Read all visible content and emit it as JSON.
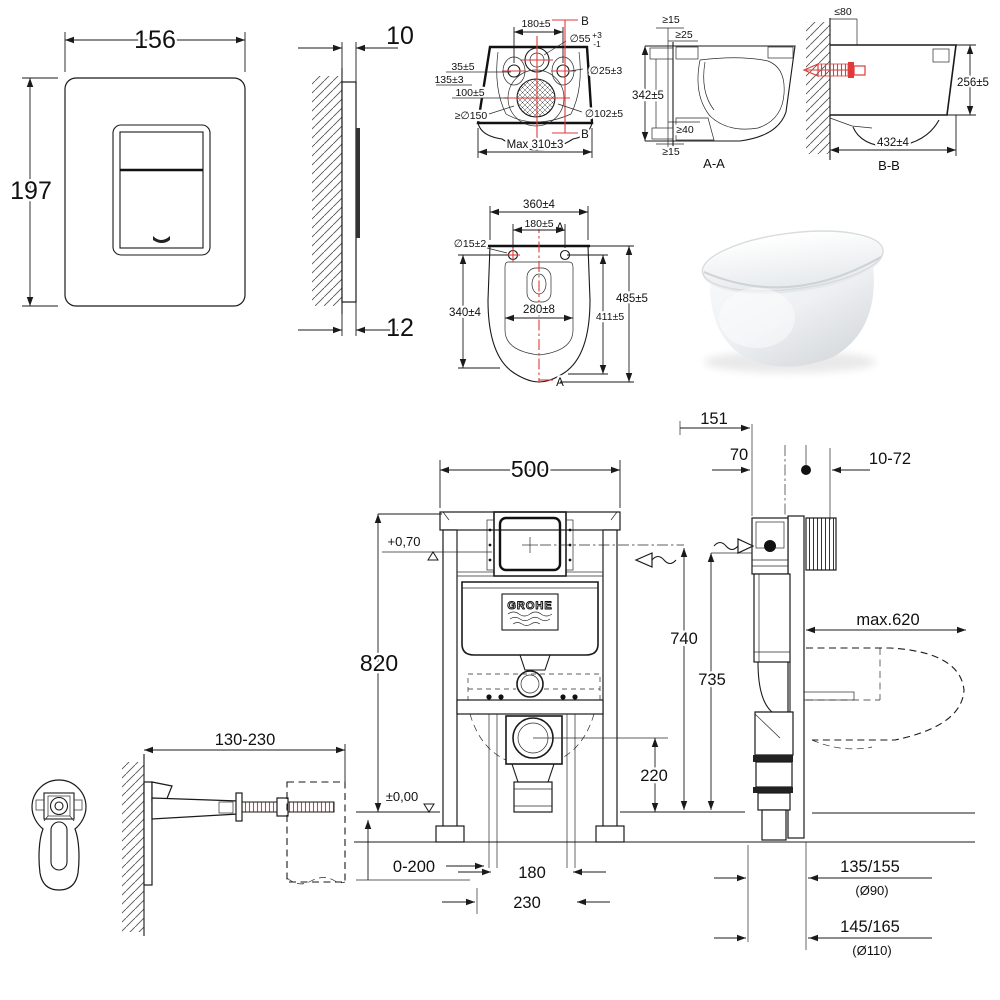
{
  "sheet": {
    "description": "GROHE wall-hung toilet and concealed cistern frame installation dimension drawing",
    "line_color": "#1a1a1a",
    "accent_red": "#e03a3a",
    "background": "#ffffff"
  },
  "views": {
    "pf": {
      "name": "flush-plate-front",
      "w": "156",
      "h": "197"
    },
    "ps": {
      "name": "flush-plate-side",
      "t": "10",
      "b": "12"
    },
    "rv": {
      "name": "toilet-rear-view",
      "spacing": "180±5",
      "inlet": "∅55",
      "tolu": "+3",
      "told": "-1",
      "a": "35±5",
      "b": "135±3",
      "c": "100±5",
      "fix": "∅25±3",
      "clr": "≥∅150",
      "out": "∅102±5",
      "maxw": "Max 310±3",
      "sec": "B"
    },
    "aa": {
      "name": "section-A-A",
      "t1": "≥15",
      "t2": "≥25",
      "h": "342±5",
      "b2": "≥40",
      "b1": "≥15",
      "lbl": "A-A"
    },
    "bb": {
      "name": "section-B-B",
      "t": "≤80",
      "h": "256±5",
      "w": "432±4",
      "lbl": "B-B"
    },
    "tv": {
      "name": "toilet-top-view",
      "w": "360±4",
      "sp": "180±5",
      "hd": "∅15±2",
      "d1": "340±4",
      "iw": "280±8",
      "dt": "485±5",
      "d2": "411±5",
      "sec": "A"
    },
    "ff": {
      "name": "frame-front-view",
      "w": "500",
      "h": "820",
      "lt": "+0,70",
      "lz": "±0,00",
      "adj": "0-200",
      "o1": "180",
      "o2": "230",
      "dh": "220",
      "brand": "GROHE"
    },
    "fs": {
      "name": "frame-side-view",
      "d151": "151",
      "d70": "70",
      "panel": "10-72",
      "h1": "740",
      "h2": "735",
      "dep": "max.620",
      "oa": "135/155",
      "oad": "(Ø90)",
      "ob": "145/165",
      "obd": "(Ø110)"
    },
    "br": {
      "name": "wall-bracket",
      "range": "130-230"
    }
  }
}
